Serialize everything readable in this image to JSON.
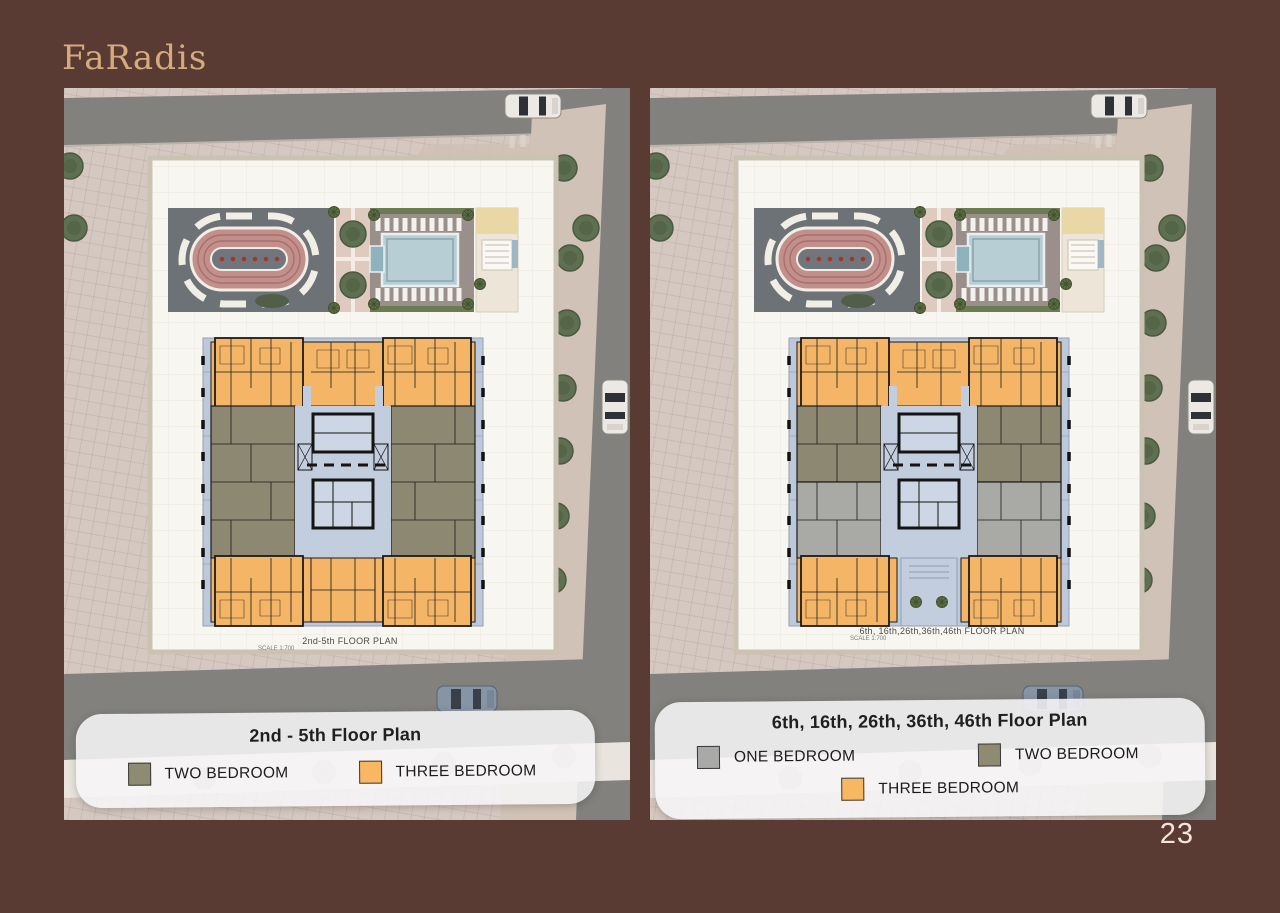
{
  "brand": {
    "logo": "FaRadis"
  },
  "page": {
    "number": "23"
  },
  "colors": {
    "page_background": "#593b33",
    "brand_gold": "#d4ab7c",
    "one_bedroom": "#a9a9a7",
    "two_bedroom": "#8f8a72",
    "three_bedroom": "#f7b763"
  },
  "panels": [
    {
      "id": "left",
      "plan_label": "2nd-5th FLOOR PLAN",
      "plan_scale": "SCALE 1:700",
      "legend": {
        "title": "2nd - 5th Floor Plan",
        "items": [
          {
            "label": "TWO BEDROOM",
            "color": "#8f8a72"
          },
          {
            "label": "THREE BEDROOM",
            "color": "#f7b763"
          }
        ]
      }
    },
    {
      "id": "right",
      "plan_label": "6th, 16th,26th,36th,46th FLOOR PLAN",
      "plan_scale": "SCALE 1:700",
      "legend": {
        "title": "6th, 16th, 26th, 36th, 46th Floor Plan",
        "items": [
          {
            "label": "ONE BEDROOM",
            "color": "#a9a9a7"
          },
          {
            "label": "TWO BEDROOM",
            "color": "#8f8a72"
          },
          {
            "label": "THREE BEDROOM",
            "color": "#f7b763"
          }
        ]
      }
    }
  ]
}
